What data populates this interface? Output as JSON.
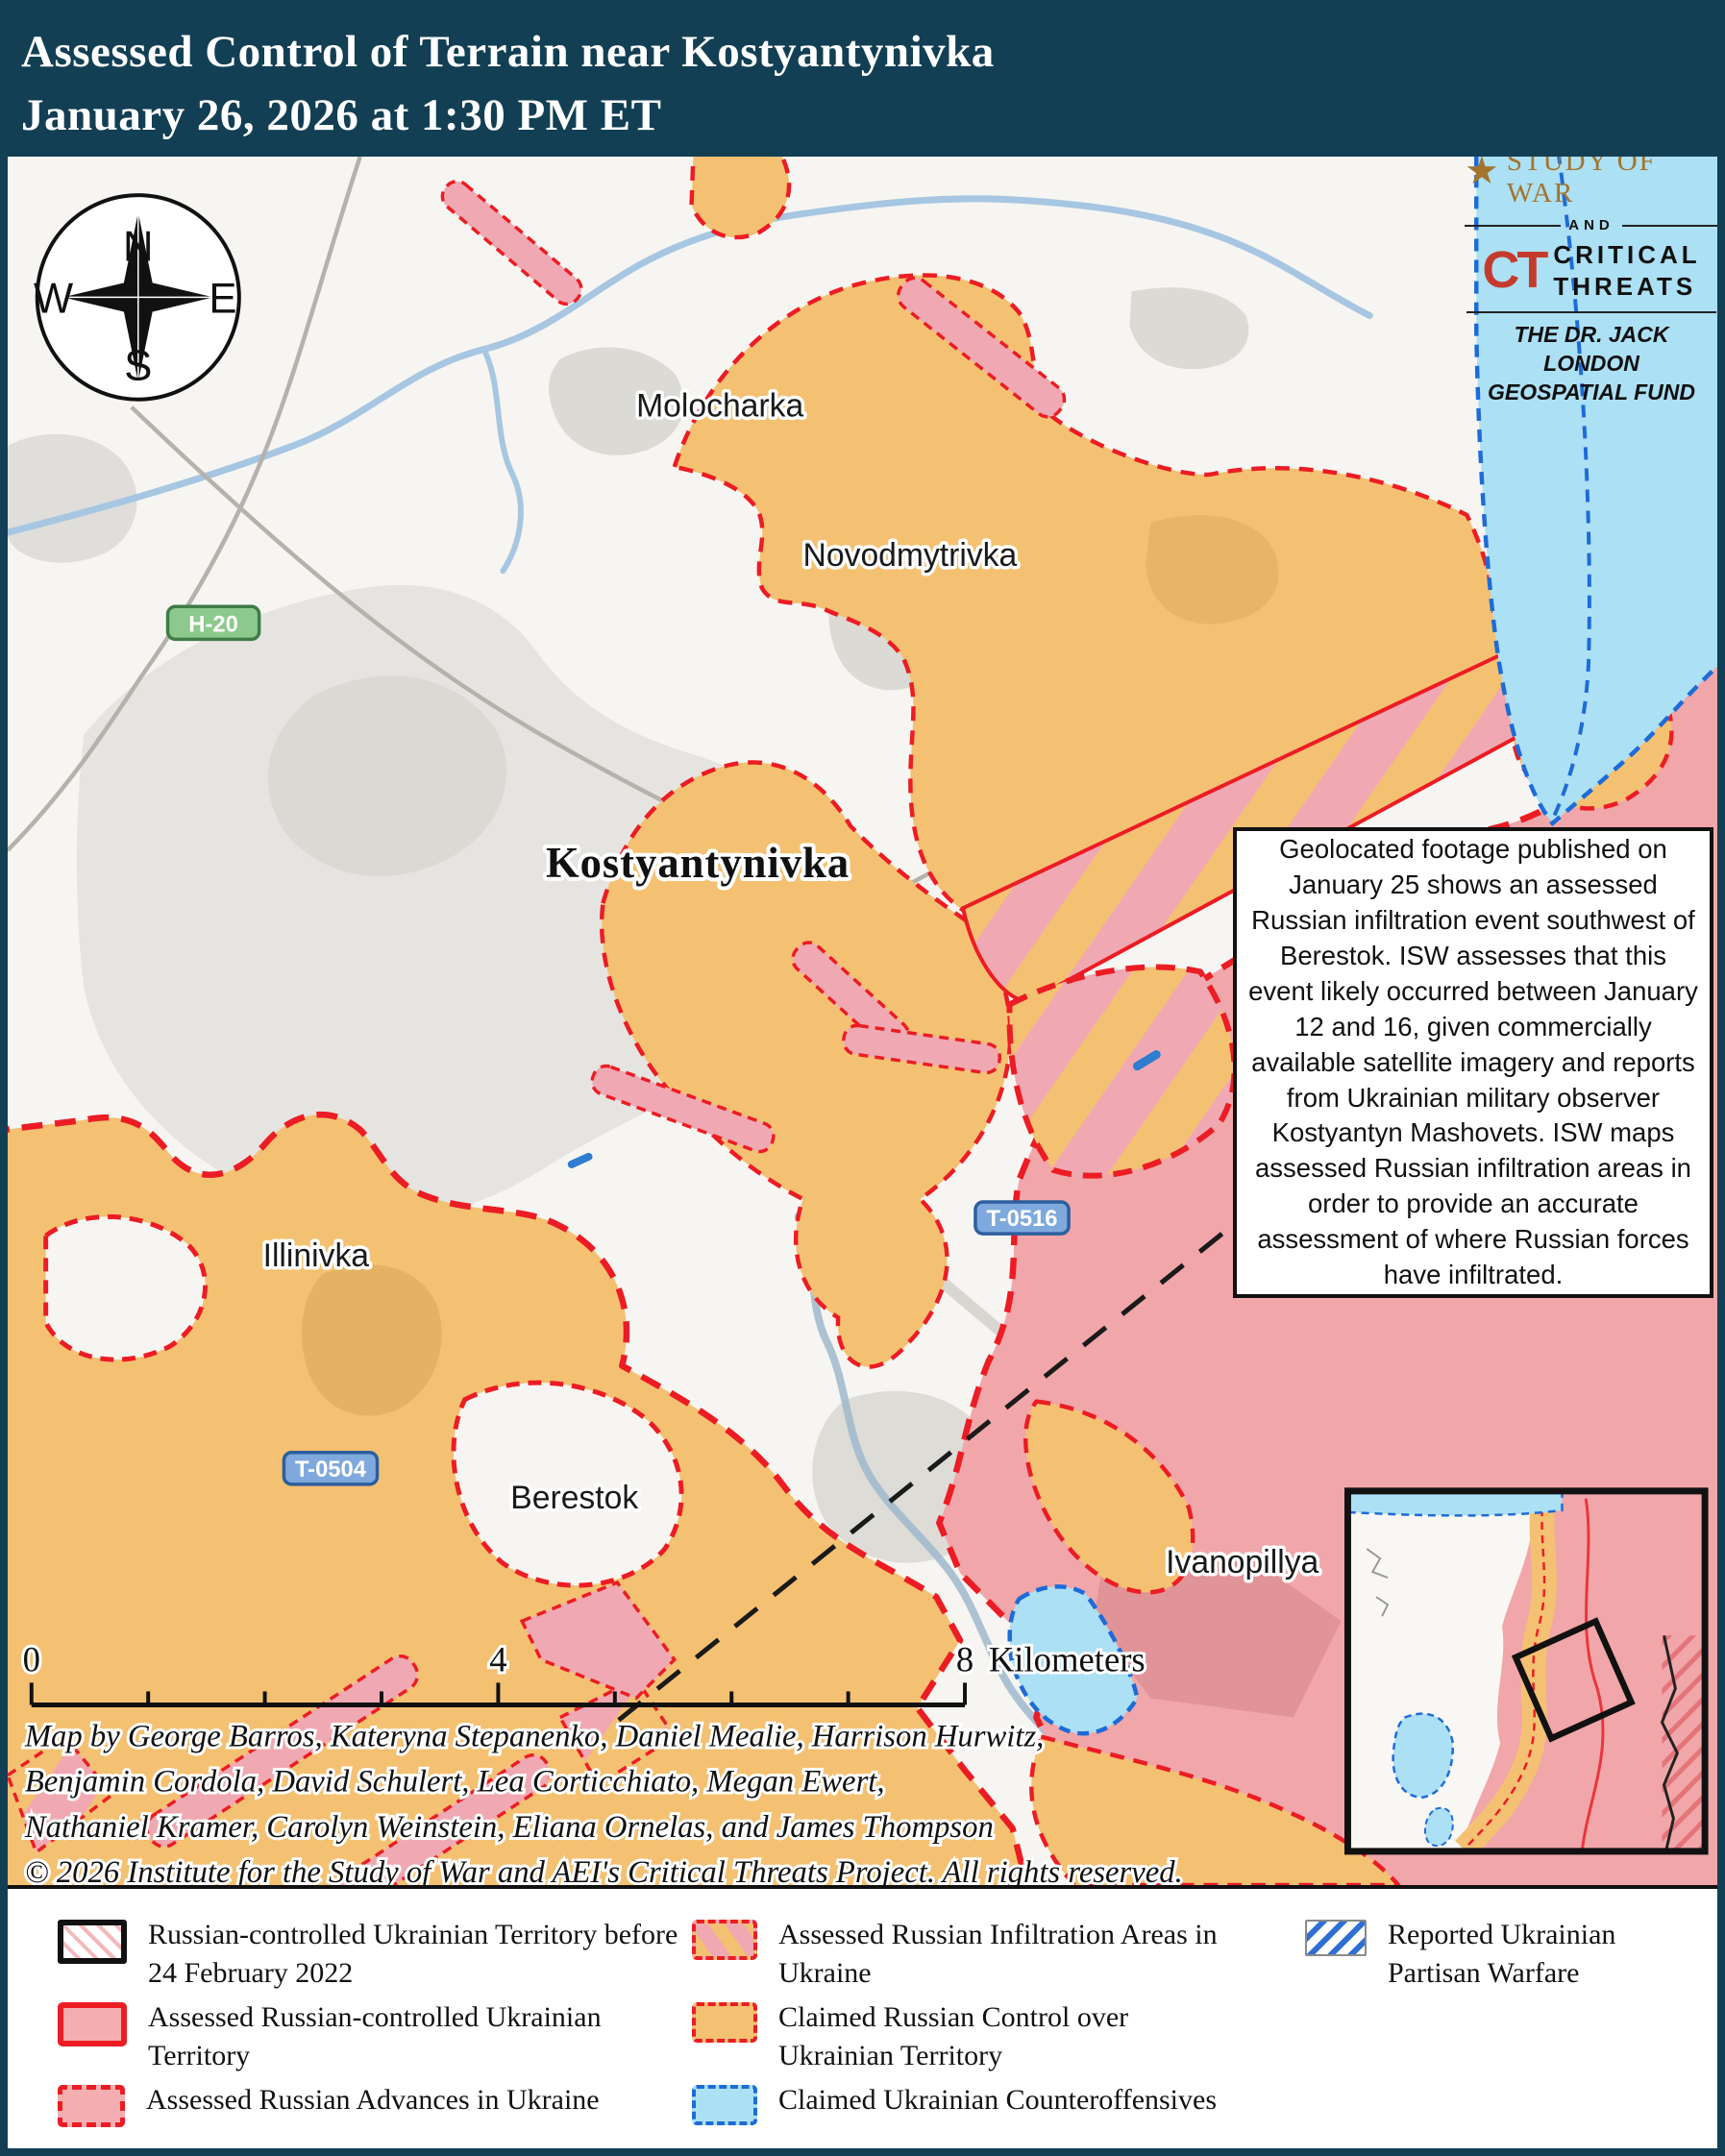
{
  "title": {
    "line1": "Assessed Control of Terrain near Kostyantynivka",
    "line2": "January 26, 2026 at 1:30 PM ET"
  },
  "logo": {
    "isw": "ISW",
    "institute": "INSTITUTE FOR THE",
    "study_of_war": "STUDY OF WAR",
    "and": "AND",
    "ct": "CT",
    "critical": "CRITICAL",
    "threats": "THREATS",
    "fund_line1": "THE DR. JACK LONDON",
    "fund_line2": "GEOSPATIAL FUND"
  },
  "compass": {
    "n": "N",
    "e": "E",
    "s": "S",
    "w": "W"
  },
  "map_labels": {
    "molocharka": "Molocharka",
    "novodmytrivka": "Novodmytrivka",
    "kostyantynivka": "Kostyantynivka",
    "predtechyne": "Predtechyne",
    "illinivka": "Illinivka",
    "berestok": "Berestok",
    "ivanopillya": "Ivanopillya"
  },
  "road_badges": {
    "h20": "H-20",
    "t0516": "T-0516",
    "t0504": "T-0504"
  },
  "annotation": {
    "text": "Geolocated footage published on January 25 shows an assessed Russian infiltration event southwest of Berestok. ISW assesses that this event likely occurred between January 12 and 16, given commercially available satellite imagery and reports from Ukrainian military observer Kostyantyn Mashovets. ISW maps assessed Russian infiltration areas in order to provide an accurate assessment of where Russian forces have infiltrated."
  },
  "scale_bar": {
    "zero": "0",
    "four": "4",
    "eight": "8",
    "unit": "Kilometers"
  },
  "attribution": {
    "line1": "Map by George Barros, Kateryna Stepanenko, Daniel Mealie, Harrison Hurwitz,",
    "line2": "Benjamin Cordola, David Schulert, Lea Corticchiato, Megan Ewert,",
    "line3": "Nathaniel Kramer, Carolyn Weinstein, Eliana Ornelas, and James Thompson",
    "line4": "© 2026 Institute for the Study of War and AEI's Critical Threats Project. All rights reserved."
  },
  "legend": {
    "items": [
      {
        "label": "Russian-controlled Ukrainian Territory before 24 February 2022"
      },
      {
        "label": "Assessed Russian-controlled Ukrainian Territory"
      },
      {
        "label": "Assessed Russian Advances in Ukraine"
      },
      {
        "label": "Assessed Russian Infiltration Areas in Ukraine"
      },
      {
        "label": "Claimed Russian Control over Ukrainian Territory"
      },
      {
        "label": "Claimed Ukrainian Counteroffensives"
      },
      {
        "label": "Reported Ukrainian Partisan Warfare"
      }
    ]
  },
  "colors": {
    "title_bg": "#123F54",
    "claimed_russian_orange": "#F4C172",
    "assessed_russian_pink": "#F1A6A9",
    "infiltration_pink": "#F0A9B2",
    "counteroffensive_cyan": "#ACE0F4",
    "advance_red": "#EC1C24",
    "ukrainian_blue": "#1E6BD8",
    "river_blue": "#A6C6E2",
    "road_gray": "#B5B2AC"
  }
}
